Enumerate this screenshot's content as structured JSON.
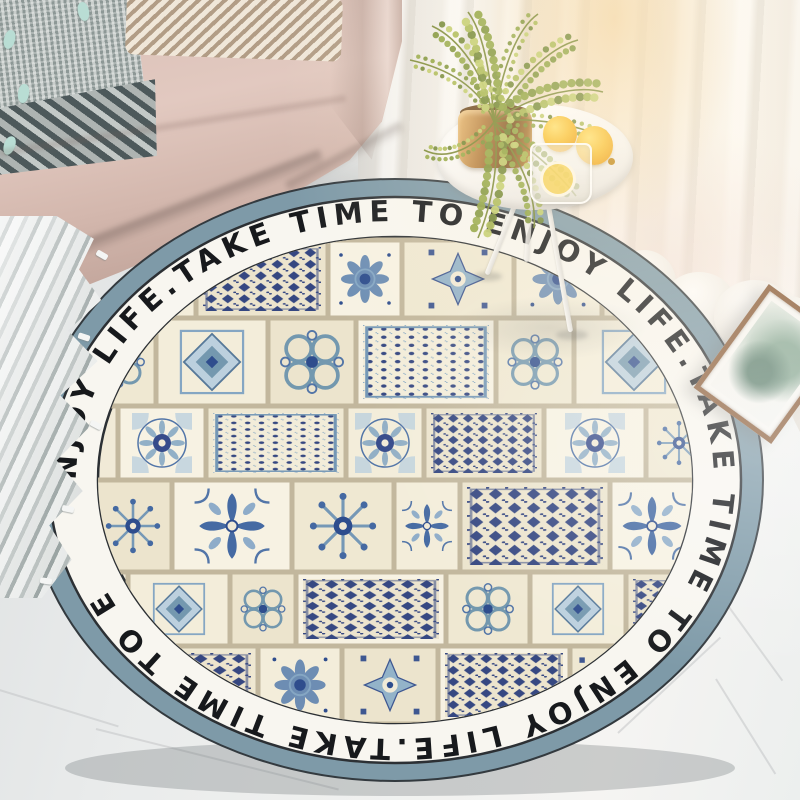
{
  "rug": {
    "ring_phrase": "TAKE TIME TO ENJOY LIFE.",
    "ring_repetitions": 3,
    "ring_text_rendered": "NJOY LIFE.TAKE TIME TO ENJOY LIFE.TAKE TIME TO ENJOY LIFE.TAKE TIME TO E",
    "colors": {
      "border_band": "#7E9AA8",
      "ring_background": "#F8F6F0",
      "ring_text": "#17191C",
      "ring_outline": "#2C3034",
      "tile_background": "#F1EAD7",
      "tile_grout": "#C2B79D",
      "tile_navy": "#24458A",
      "tile_blue": "#4A6FA5",
      "tile_steel": "#7FA3C2",
      "tile_teal": "#6D94AD",
      "tile_pale": "#B9CFDF"
    }
  },
  "palette": {
    "sofa": "#D5BBB2",
    "pillow_gray": "#8D9896",
    "pillow_mint_tassel": "#B9DDD4",
    "blanket": "#DFE2E1",
    "floor": "#EDEFEF",
    "curtain": "#F6F1EA",
    "lemon": "#F6B81E",
    "pot_copper": "#B67F3F",
    "plant_green": "#8DA23D",
    "frame_copper": "#8A5C39"
  }
}
